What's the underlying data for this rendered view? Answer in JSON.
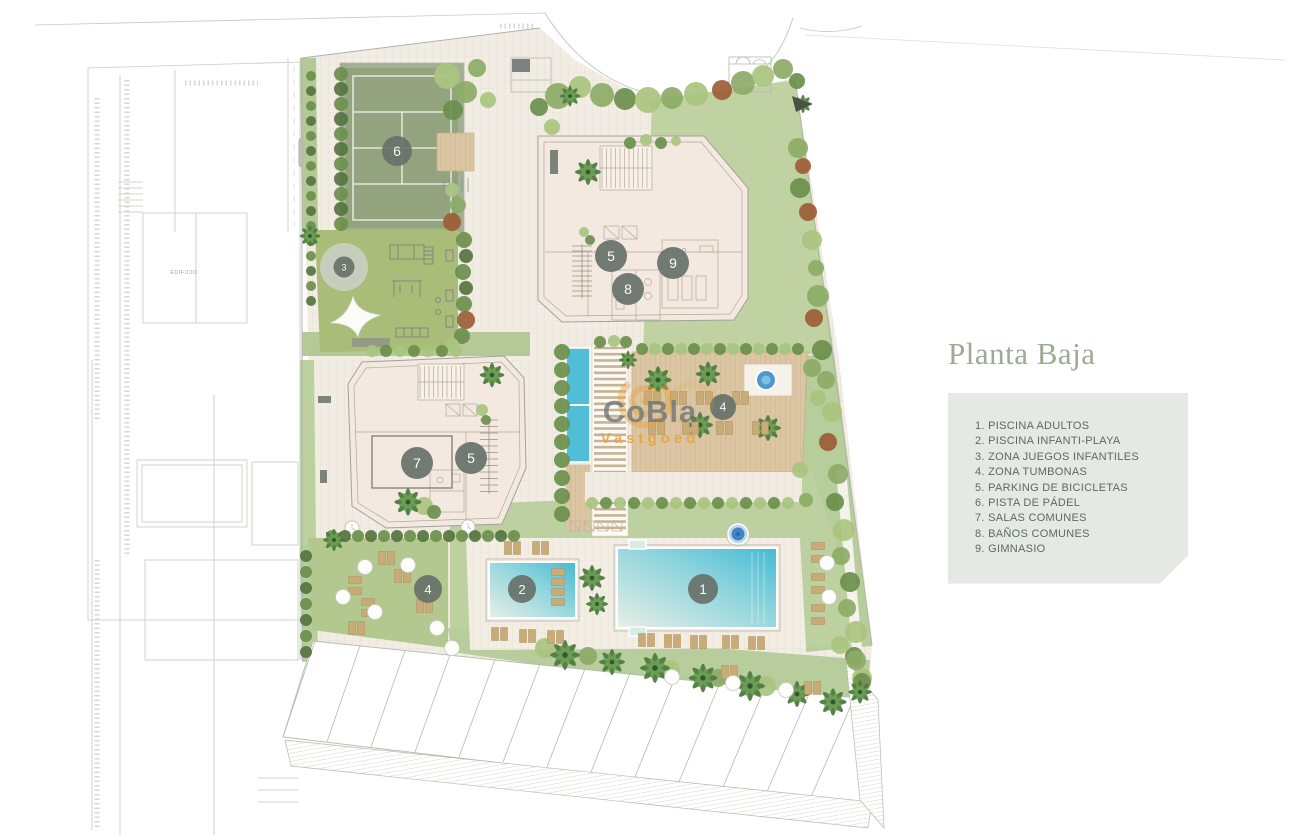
{
  "title": "Planta Baja",
  "legend": {
    "items": [
      "1. PISCINA ADULTOS",
      "2. PISCINA INFANTI-PLAYA",
      "3. ZONA JUEGOS INFANTILES",
      "4. ZONA TUMBONAS",
      "5. PARKING DE BICICLETAS",
      "6. PISTA DE PÁDEL",
      "7. SALAS COMUNES",
      "8. BAÑOS COMUNES",
      "9. GIMNASIO"
    ]
  },
  "watermark": {
    "name": "CoBla",
    "tagline": "Vastgoed"
  },
  "plan": {
    "neighbor_label": "EDIFICIO",
    "markers": [
      {
        "n": "1",
        "x": 703,
        "y": 589,
        "d": 30,
        "label": "PISCINA ADULTOS"
      },
      {
        "n": "2",
        "x": 522,
        "y": 589,
        "d": 28,
        "label": "PISCINA INFANTI-PLAYA"
      },
      {
        "n": "3",
        "x": 344,
        "y": 267,
        "d": 21,
        "halo": true,
        "label": "ZONA JUEGOS INFANTILES"
      },
      {
        "n": "4",
        "x": 723,
        "y": 407,
        "d": 26,
        "label": "ZONA TUMBONAS"
      },
      {
        "n": "4",
        "x": 428,
        "y": 589,
        "d": 28,
        "label": "ZONA TUMBONAS"
      },
      {
        "n": "5",
        "x": 611,
        "y": 256,
        "d": 32,
        "label": "PARKING DE BICICLETAS"
      },
      {
        "n": "5",
        "x": 471,
        "y": 458,
        "d": 32,
        "label": "PARKING DE BICICLETAS"
      },
      {
        "n": "6",
        "x": 397,
        "y": 151,
        "d": 30,
        "label": "PISTA DE PÁDEL"
      },
      {
        "n": "7",
        "x": 417,
        "y": 463,
        "d": 32,
        "label": "SALAS COMUNES"
      },
      {
        "n": "8",
        "x": 628,
        "y": 289,
        "d": 32,
        "label": "BAÑOS COMUNES"
      },
      {
        "n": "9",
        "x": 673,
        "y": 263,
        "d": 32,
        "label": "GIMNASIO"
      }
    ]
  },
  "colors": {
    "title": "#9cab92",
    "legend_bg": "#e5e9e3",
    "legend_text": "#5d6a5d",
    "marker": "#68726a",
    "accent_orange": "#e8a23c",
    "watermark_gray": "#6f757a",
    "lawn": "#c0d2a2",
    "court": "#93a37d",
    "playground": "#a9bd78",
    "paving": "#f1ece4",
    "building": "#f3e9e0",
    "deck": "#dbc5a2",
    "pool": "#4fbed6",
    "lounger": "#c9ab77"
  }
}
